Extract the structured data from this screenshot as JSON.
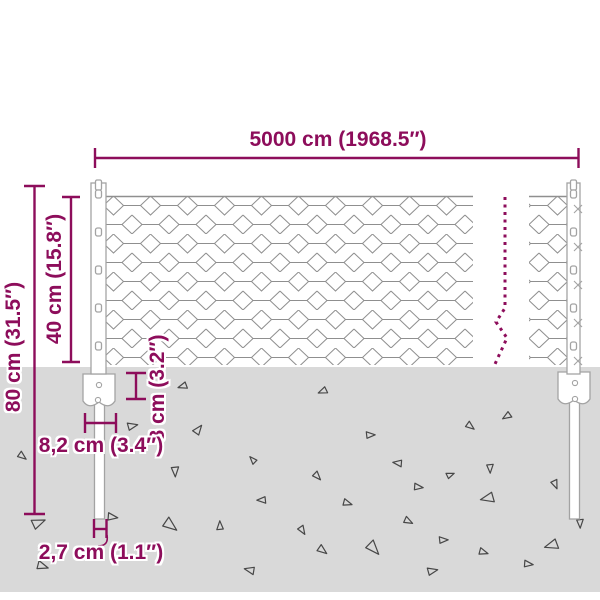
{
  "diagram": {
    "type": "product-dimension-diagram",
    "subject": "chain-link wire mesh fence with steel posts and ground anchors"
  },
  "colors": {
    "accent": "#8d0d5b",
    "ground": "#d9d9d9",
    "mesh_wire": "#8f8f8f",
    "steel_outline": "#a3a3a3"
  },
  "dimensions": {
    "total_length": "5000 cm (1968.5″)",
    "total_height": "80 cm (31.5″)",
    "fence_height": "40 cm (15.8″)",
    "anchor_height": "8 cm (3.2″)",
    "anchor_width": "8,2 cm (3.4″)",
    "post_diameter": "2,7 cm (1.1″)"
  },
  "ground": {
    "triangles": [
      {
        "x": 183,
        "y": 386,
        "s": 8,
        "rot": 15
      },
      {
        "x": 132,
        "y": 426,
        "s": 9,
        "rot": 200
      },
      {
        "x": 198,
        "y": 430,
        "s": 9,
        "rot": 160
      },
      {
        "x": 22,
        "y": 456,
        "s": 8,
        "rot": 250
      },
      {
        "x": 175,
        "y": 471,
        "s": 9,
        "rot": 300
      },
      {
        "x": 253,
        "y": 460,
        "s": 7,
        "rot": 80
      },
      {
        "x": 262,
        "y": 500,
        "s": 8,
        "rot": 30
      },
      {
        "x": 38,
        "y": 523,
        "s": 12,
        "rot": 190
      },
      {
        "x": 112,
        "y": 517,
        "s": 9,
        "rot": 220
      },
      {
        "x": 170,
        "y": 525,
        "s": 13,
        "rot": 250
      },
      {
        "x": 220,
        "y": 526,
        "s": 8,
        "rot": 120
      },
      {
        "x": 42,
        "y": 566,
        "s": 10,
        "rot": 230
      },
      {
        "x": 250,
        "y": 570,
        "s": 9,
        "rot": 45
      },
      {
        "x": 323,
        "y": 391,
        "s": 8,
        "rot": 10
      },
      {
        "x": 370,
        "y": 435,
        "s": 8,
        "rot": 210
      },
      {
        "x": 470,
        "y": 426,
        "s": 8,
        "rot": 250
      },
      {
        "x": 507,
        "y": 416,
        "s": 8,
        "rot": 0
      },
      {
        "x": 398,
        "y": 463,
        "s": 8,
        "rot": 40
      },
      {
        "x": 450,
        "y": 475,
        "s": 7,
        "rot": 190
      },
      {
        "x": 490,
        "y": 468,
        "s": 8,
        "rot": 300
      },
      {
        "x": 418,
        "y": 487,
        "s": 8,
        "rot": 220
      },
      {
        "x": 317,
        "y": 476,
        "s": 8,
        "rot": 260
      },
      {
        "x": 347,
        "y": 503,
        "s": 8,
        "rot": 230
      },
      {
        "x": 555,
        "y": 484,
        "s": 8,
        "rot": 280
      },
      {
        "x": 488,
        "y": 498,
        "s": 12,
        "rot": 20
      },
      {
        "x": 408,
        "y": 521,
        "s": 8,
        "rot": 240
      },
      {
        "x": 302,
        "y": 530,
        "s": 8,
        "rot": 270
      },
      {
        "x": 443,
        "y": 540,
        "s": 8,
        "rot": 210
      },
      {
        "x": 322,
        "y": 550,
        "s": 9,
        "rot": 250
      },
      {
        "x": 373,
        "y": 548,
        "s": 13,
        "rot": 260
      },
      {
        "x": 483,
        "y": 552,
        "s": 8,
        "rot": 230
      },
      {
        "x": 528,
        "y": 564,
        "s": 8,
        "rot": 220
      },
      {
        "x": 552,
        "y": 545,
        "s": 12,
        "rot": 15
      },
      {
        "x": 580,
        "y": 523,
        "s": 8,
        "rot": 300
      },
      {
        "x": 432,
        "y": 571,
        "s": 9,
        "rot": 200
      }
    ]
  }
}
